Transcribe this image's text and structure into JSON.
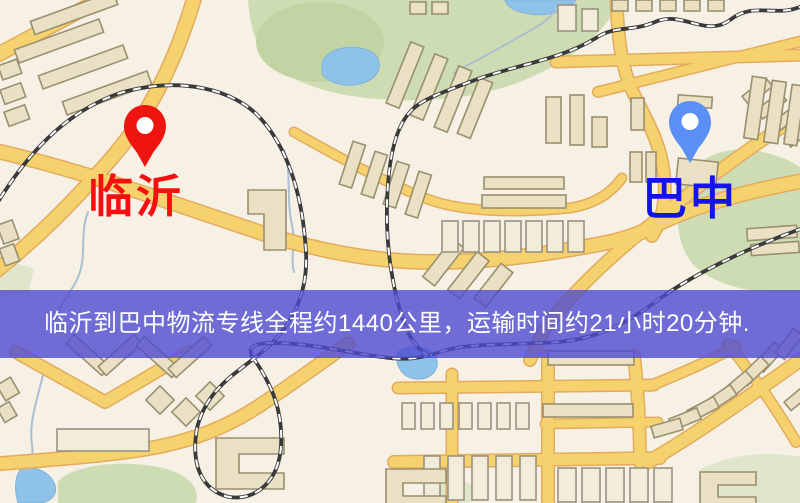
{
  "window": {
    "width": 800,
    "height": 503
  },
  "map": {
    "kind": "street-map",
    "colors": {
      "background": "#f6f0e5",
      "road_fill": "#f5d26e",
      "road_casing": "#e3ab5e",
      "park": "#cedcb4",
      "water": "#8fc2e8",
      "building": "#eae0c3",
      "railway": "#3a3a3a"
    },
    "markers": {
      "origin": {
        "label": "临沂",
        "pin_color": "#ee1510",
        "label_color": "#f50f0f"
      },
      "destination": {
        "label": "巴中",
        "pin_color": "#5b8ff5",
        "label_color": "#1414e8"
      }
    }
  },
  "banner": {
    "text": "临沂到巴中物流专线全程约1440公里，运输时间约21小时20分钟.",
    "background": "#4d4bd1",
    "opacity": 0.8,
    "text_color": "#ffffff"
  }
}
